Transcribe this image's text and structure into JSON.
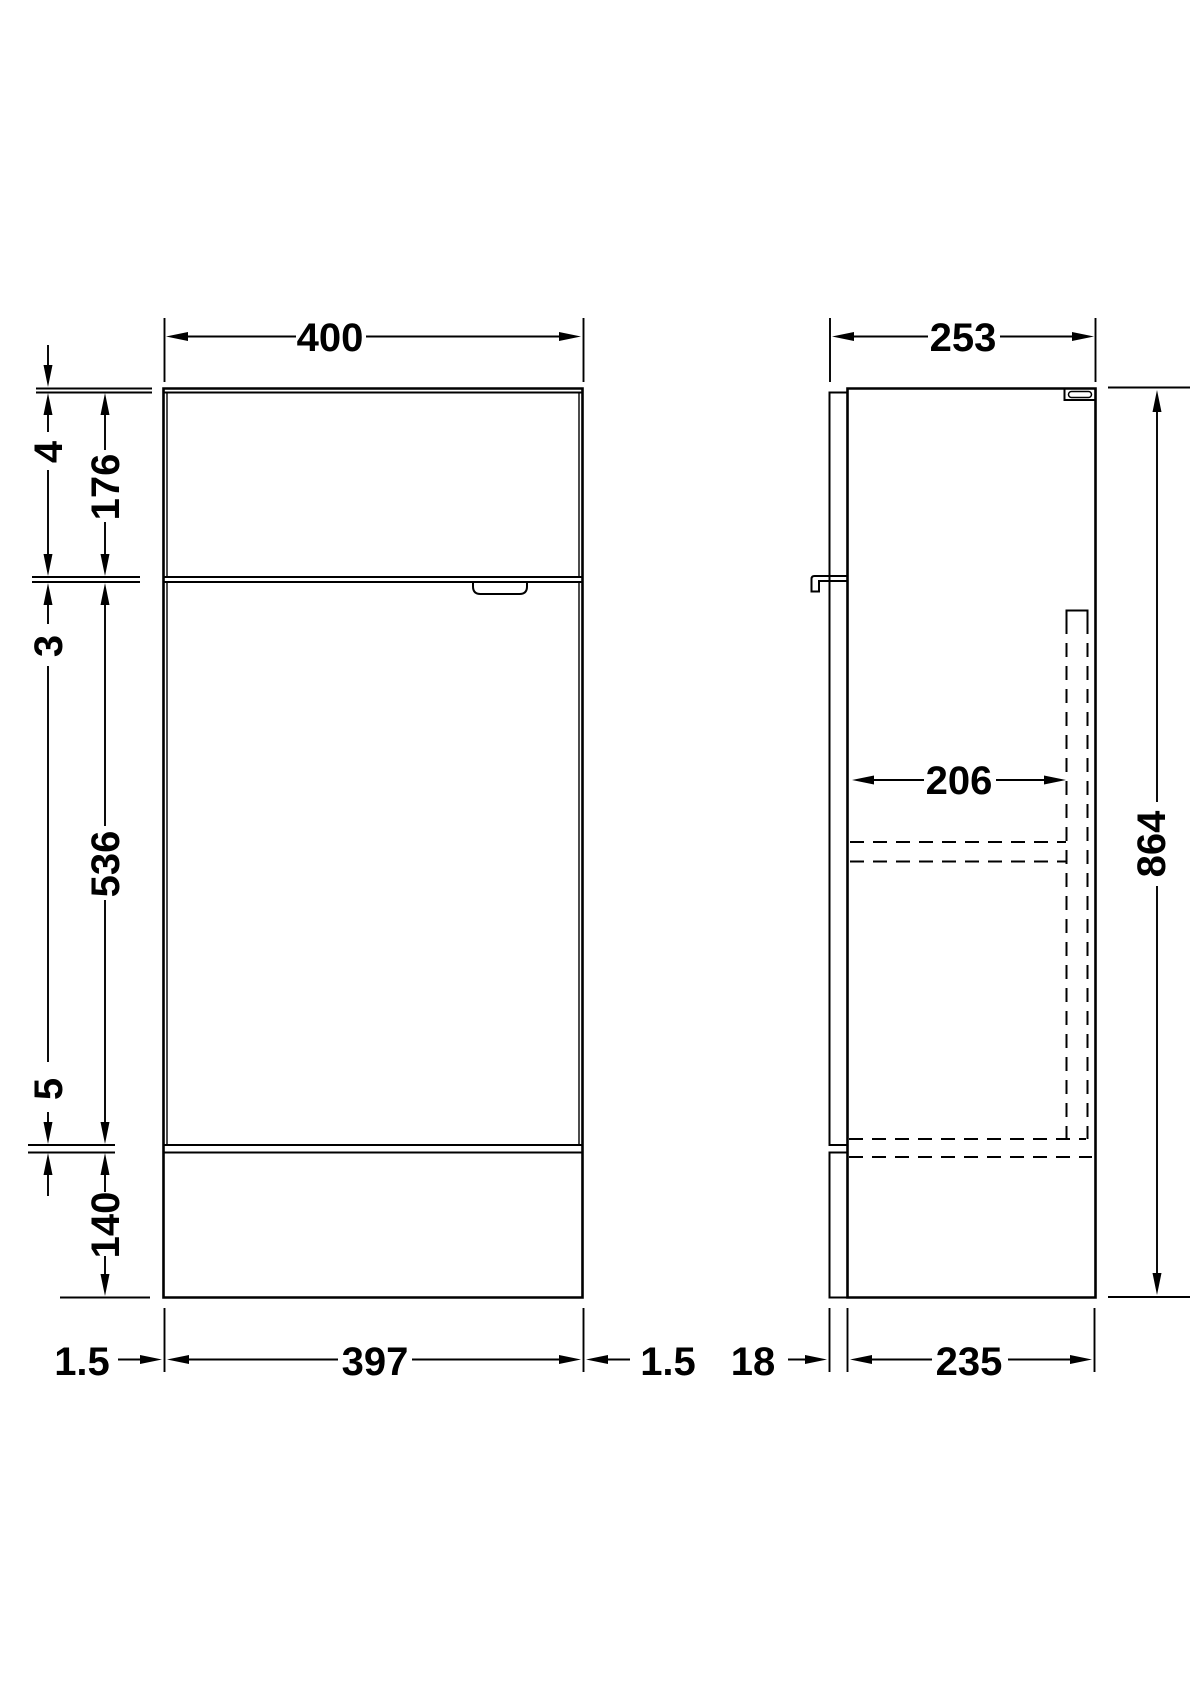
{
  "front_view": {
    "width": "400",
    "worktop_thickness": "4",
    "drawer_front_height": "176",
    "drawer_door_gap": "3",
    "door_height": "536",
    "door_plinth_gap": "5",
    "plinth_height": "140",
    "base_left_inset": "1.5",
    "base_width": "397",
    "base_right_inset": "1.5"
  },
  "side_view": {
    "depth": "253",
    "internal_clear_depth": "206",
    "height": "864",
    "front_panel_thickness": "18",
    "carcass_depth": "235"
  },
  "style": {
    "line_color": "#000000",
    "background_color": "#ffffff"
  }
}
